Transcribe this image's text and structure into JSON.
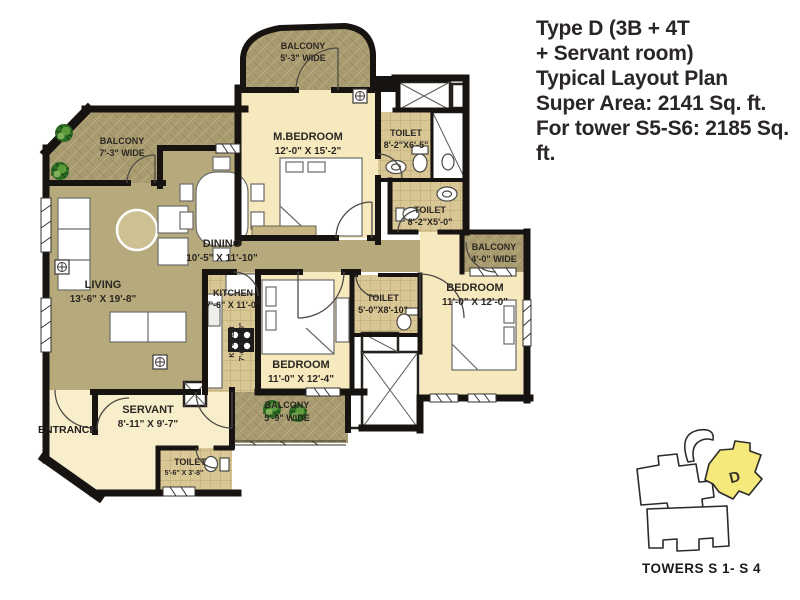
{
  "title": {
    "lines": [
      "Type D (3B + 4T",
      "+ Servant room)",
      "Typical Layout Plan",
      "Super Area: 2141 Sq. ft.",
      "For tower S5-S6: 2185 Sq. ft."
    ]
  },
  "plan": {
    "rooms": {
      "balcony_top": {
        "label": "BALCONY",
        "dims": "5'-3\" WIDE"
      },
      "m_bedroom": {
        "label": "M.BEDROOM",
        "dims": "12'-0\" X 15'-2\""
      },
      "toilet_master": {
        "label": "TOILET",
        "dims": "8'-2\"X6'-5\""
      },
      "toilet_common": {
        "label": "TOILET",
        "dims": "8'-2\"X5'-0\""
      },
      "balcony_left": {
        "label": "BALCONY",
        "dims": "7'-3\" WIDE"
      },
      "dining": {
        "label": "DINING",
        "dims": "10'-5\" X 11'-10\""
      },
      "living": {
        "label": "LIVING",
        "dims": "13'-6\" X 19'-8\""
      },
      "kitchen": {
        "label": "KITCHEN",
        "dims": "7'-6\" X 11'-0\""
      },
      "kitchen_platform": {
        "label": "KITCHEN",
        "dims": "7'-6\"X11'-0\""
      },
      "balcony_right": {
        "label": "BALCONY",
        "dims": "4'-0\" WIDE"
      },
      "bedroom_right": {
        "label": "BEDROOM",
        "dims": "11'-0\" X 12'-0\""
      },
      "toilet_middle": {
        "label": "TOILET",
        "dims": "5'-0\"X8'-10\""
      },
      "bedroom_middle": {
        "label": "BEDROOM",
        "dims": "11'-0\" X 12'-4\""
      },
      "servant": {
        "label": "SERVANT",
        "dims": "8'-11\" X 9'-7\""
      },
      "balcony_bottom": {
        "label": "BALCONY",
        "dims": "5'-9\" WIDE"
      },
      "toilet_servant": {
        "label": "TOILET",
        "dims": "5'-6\" X 3'-8\""
      },
      "entrance": {
        "label": "ENTRANCE"
      }
    }
  },
  "key_plan": {
    "unit": "D",
    "caption": "TOWERS S 1- S 4"
  },
  "colors": {
    "wall": "#171310",
    "room_cream": "#f6e9bd",
    "floor_khaki": "#b6a97b",
    "balcony_khaki": "#a89a6f",
    "tile_tan": "#d9c795",
    "keyplan_yellow": "#f4e97a",
    "plant_green": "#3f7d2c"
  },
  "icons": {
    "electrical_point": "crosshair-in-square",
    "plant": "potted-plant",
    "shaft": "x-cross"
  }
}
